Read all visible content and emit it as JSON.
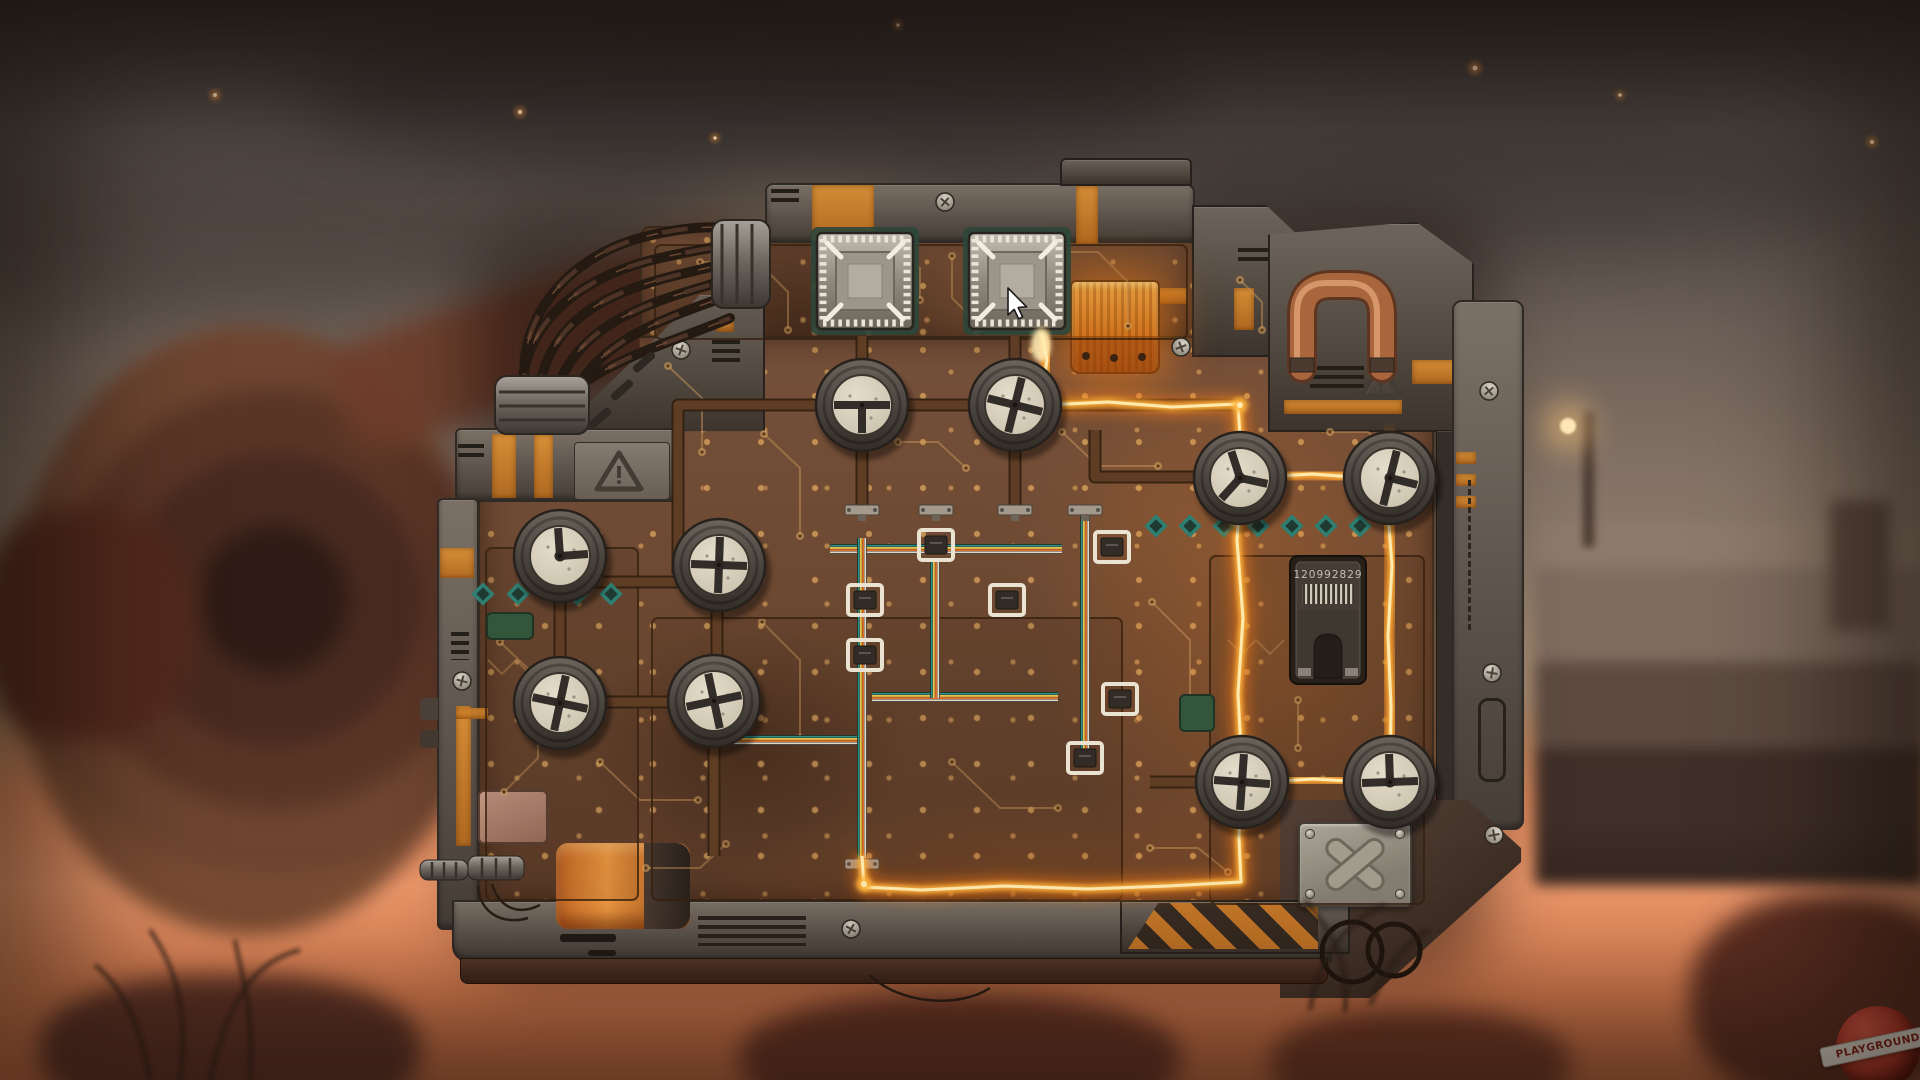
{
  "scene_type": "wasteland circuit-board valve puzzle",
  "watermark": {
    "text": "PLAYGROUND"
  },
  "device": {
    "chip_label": "120992829"
  },
  "cursor": {
    "x": 1008,
    "y": 288
  },
  "colors": {
    "trace": "#c89358",
    "pad": "#d9a763",
    "pipe_dark": "#32200f",
    "pipe": "#5f3d24",
    "glow_outer": "#ff7e14",
    "glow_mid": "#ffb43c",
    "glow_core": "#ffeab0",
    "teal": "#2e7f72",
    "dial_ring": "#514b45",
    "dial_face": "#d9d2c0",
    "spoke": "#322d28",
    "ribbon": [
      "#2e8f86",
      "#e8c14f",
      "#d96f28",
      "#ded8c8"
    ],
    "copper": "#a9663d",
    "accent_orange": "#d9822b"
  },
  "scene": {
    "dials": [
      {
        "x": 862,
        "y": 405,
        "s": "tee",
        "rot": 0,
        "hub": 0
      },
      {
        "x": 1015,
        "y": 405,
        "s": "cross",
        "rot": 14,
        "hub": 1
      },
      {
        "x": 1240,
        "y": 478,
        "s": "wye",
        "rot": -8,
        "hub": 1
      },
      {
        "x": 1390,
        "y": 478,
        "s": "tee",
        "rot": -76,
        "hub": 1
      },
      {
        "x": 560,
        "y": 556,
        "s": "ell",
        "rot": -4,
        "hub": 1
      },
      {
        "x": 719,
        "y": 565,
        "s": "cross",
        "rot": 2,
        "hub": 1
      },
      {
        "x": 560,
        "y": 703,
        "s": "cross",
        "rot": 12,
        "hub": 1
      },
      {
        "x": 714,
        "y": 701,
        "s": "cross",
        "rot": -12,
        "hub": 0
      },
      {
        "x": 1242,
        "y": 782,
        "s": "cross",
        "rot": 4,
        "hub": 1
      },
      {
        "x": 1390,
        "y": 782,
        "s": "tee",
        "rot": 178,
        "hub": 1
      }
    ],
    "spoke_styles": {
      "cross": [
        0,
        90,
        180,
        270
      ],
      "tee": [
        0,
        90,
        180
      ],
      "ell": [
        270,
        0
      ],
      "pointer": [
        90
      ],
      "wye": [
        20,
        140,
        260
      ]
    },
    "sockets": [
      {
        "x": 865,
        "y": 281
      },
      {
        "x": 1017,
        "y": 281
      }
    ],
    "pipes": [
      [
        [
          678,
          574
        ],
        [
          678,
          405
        ],
        [
          1240,
          405
        ]
      ],
      [
        [
          862,
          336
        ],
        [
          862,
          512
        ]
      ],
      [
        [
          1015,
          336
        ],
        [
          1015,
          512
        ]
      ],
      [
        [
          1095,
          430
        ],
        [
          1095,
          477
        ],
        [
          1240,
          477
        ]
      ],
      [
        [
          560,
          582
        ],
        [
          717,
          582
        ]
      ],
      [
        [
          717,
          564
        ],
        [
          717,
          702
        ]
      ],
      [
        [
          560,
          554
        ],
        [
          560,
          702
        ]
      ],
      [
        [
          558,
          702
        ],
        [
          716,
          702
        ]
      ],
      [
        [
          714,
          700
        ],
        [
          714,
          856
        ]
      ],
      [
        [
          1150,
          782
        ],
        [
          1244,
          782
        ]
      ]
    ],
    "glow": {
      "paths": [
        [
          [
            1042,
            334
          ],
          [
            1047,
            360
          ],
          [
            1043,
            386
          ],
          [
            1046,
            406
          ]
        ],
        [
          [
            1046,
            405
          ],
          [
            1108,
            402
          ],
          [
            1172,
            407
          ],
          [
            1238,
            404
          ],
          [
            1242,
            468
          ],
          [
            1237,
            540
          ],
          [
            1243,
            618
          ],
          [
            1238,
            694
          ],
          [
            1242,
            768
          ],
          [
            1239,
            838
          ],
          [
            1241,
            882
          ],
          [
            1168,
            886
          ],
          [
            1088,
            889
          ],
          [
            1004,
            886
          ],
          [
            922,
            890
          ],
          [
            864,
            887
          ],
          [
            862,
            856
          ]
        ],
        [
          [
            1261,
            477
          ],
          [
            1312,
            474
          ],
          [
            1366,
            478
          ]
        ],
        [
          [
            1391,
            434
          ],
          [
            1387,
            498
          ],
          [
            1392,
            566
          ],
          [
            1388,
            636
          ],
          [
            1391,
            706
          ],
          [
            1390,
            778
          ]
        ],
        [
          [
            1263,
            782
          ],
          [
            1313,
            779
          ],
          [
            1365,
            782
          ]
        ]
      ],
      "sparks": [
        [
          1046,
          405
        ],
        [
          1240,
          405
        ],
        [
          1241,
          477
        ],
        [
          1241,
          782
        ],
        [
          1390,
          478
        ],
        [
          1390,
          780
        ],
        [
          864,
          884
        ]
      ],
      "flame": {
        "x": 1041,
        "y": 345
      }
    },
    "ribbons": [
      {
        "o": "h",
        "pts": [
          [
            830,
            549
          ],
          [
            1062,
            549
          ]
        ]
      },
      {
        "o": "h",
        "pts": [
          [
            872,
            697
          ],
          [
            1058,
            697
          ]
        ]
      },
      {
        "o": "h",
        "pts": [
          [
            702,
            740
          ],
          [
            858,
            740
          ]
        ]
      },
      {
        "o": "v",
        "pts": [
          [
            935,
            562
          ],
          [
            935,
            698
          ]
        ]
      },
      {
        "o": "v",
        "pts": [
          [
            1085,
            505
          ],
          [
            1085,
            756
          ]
        ]
      },
      {
        "o": "v",
        "pts": [
          [
            862,
            538
          ],
          [
            862,
            858
          ]
        ]
      }
    ],
    "row_connectors": [
      [
        862,
        510
      ],
      [
        936,
        510
      ],
      [
        1015,
        510
      ],
      [
        1085,
        510
      ],
      [
        862,
        864
      ]
    ],
    "brackets": [
      [
        865,
        600
      ],
      [
        1007,
        600
      ],
      [
        865,
        655
      ],
      [
        1112,
        547
      ],
      [
        1120,
        699
      ],
      [
        1085,
        758
      ],
      [
        936,
        545
      ]
    ],
    "diamonds": {
      "left": {
        "y": 594,
        "xs": [
          483,
          518,
          577,
          611
        ]
      },
      "right": {
        "y": 526,
        "xs": [
          1156,
          1190,
          1224,
          1258,
          1292,
          1326,
          1360
        ]
      }
    },
    "green_chips": [
      [
        487,
        613,
        46,
        26
      ],
      [
        1180,
        695,
        34,
        36
      ]
    ],
    "regions": [
      [
        652,
        618,
        470,
        282
      ],
      [
        1210,
        556,
        214,
        348
      ],
      [
        655,
        245,
        532,
        94
      ],
      [
        486,
        548,
        152,
        352
      ]
    ],
    "traces": [
      [
        [
          700,
          262
        ],
        [
          758,
          262
        ],
        [
          788,
          292
        ],
        [
          788,
          330
        ]
      ],
      [
        [
          952,
          256
        ],
        [
          952,
          298
        ],
        [
          982,
          328
        ]
      ],
      [
        [
          1062,
          252
        ],
        [
          1098,
          252
        ],
        [
          1128,
          282
        ],
        [
          1128,
          326
        ]
      ],
      [
        [
          668,
          366
        ],
        [
          702,
          398
        ],
        [
          702,
          452
        ]
      ],
      [
        [
          764,
          434
        ],
        [
          800,
          468
        ],
        [
          800,
          536
        ]
      ],
      [
        [
          898,
          442
        ],
        [
          938,
          442
        ],
        [
          966,
          468
        ]
      ],
      [
        [
          1062,
          432
        ],
        [
          1098,
          466
        ],
        [
          1158,
          466
        ]
      ],
      [
        [
          500,
          642
        ],
        [
          538,
          678
        ],
        [
          538,
          758
        ],
        [
          504,
          792
        ]
      ],
      [
        [
          600,
          762
        ],
        [
          640,
          800
        ],
        [
          698,
          800
        ]
      ],
      [
        [
          762,
          622
        ],
        [
          800,
          660
        ],
        [
          800,
          738
        ]
      ],
      [
        [
          952,
          762
        ],
        [
          1000,
          808
        ],
        [
          1058,
          808
        ]
      ],
      [
        [
          1152,
          602
        ],
        [
          1190,
          640
        ],
        [
          1190,
          716
        ]
      ],
      [
        [
          1298,
          700
        ],
        [
          1298,
          748
        ]
      ],
      [
        [
          1330,
          432
        ],
        [
          1368,
          432
        ],
        [
          1398,
          460
        ]
      ],
      [
        [
          646,
          868
        ],
        [
          700,
          868
        ],
        [
          726,
          844
        ]
      ],
      [
        [
          1150,
          848
        ],
        [
          1198,
          848
        ],
        [
          1228,
          872
        ]
      ],
      [
        [
          890,
          240
        ],
        [
          920,
          268
        ],
        [
          920,
          300
        ]
      ],
      [
        [
          1240,
          280
        ],
        [
          1262,
          302
        ],
        [
          1262,
          330
        ]
      ]
    ],
    "chevrons": [
      [
        [
          488,
          660
        ],
        [
          502,
          674
        ],
        [
          516,
          660
        ],
        [
          530,
          674
        ],
        [
          544,
          660
        ]
      ],
      [
        [
          1228,
          640
        ],
        [
          1242,
          654
        ],
        [
          1256,
          640
        ],
        [
          1270,
          654
        ],
        [
          1284,
          640
        ]
      ]
    ],
    "screws": [
      [
        681,
        350,
        20
      ],
      [
        945,
        202,
        40
      ],
      [
        1181,
        347,
        70
      ],
      [
        462,
        681,
        15
      ],
      [
        1489,
        391,
        50
      ],
      [
        1492,
        673,
        10
      ],
      [
        1494,
        835,
        80
      ],
      [
        851,
        929,
        30
      ]
    ],
    "xplate_screws": [
      [
        1310,
        834
      ],
      [
        1400,
        834
      ],
      [
        1310,
        894
      ],
      [
        1400,
        894
      ]
    ],
    "cap_dots": [
      [
        1086,
        356
      ],
      [
        1114,
        358
      ],
      [
        1142,
        357
      ]
    ],
    "triangles": [
      {
        "name": "warning-triangle-icon",
        "pts": [
          [
            619,
            453
          ],
          [
            597,
            489
          ],
          [
            641,
            489
          ]
        ],
        "bang": [
          619,
          466,
          482
        ]
      },
      {
        "name": "warning-triangle-icon",
        "pts": [
          [
            1381,
            364
          ],
          [
            1362,
            396
          ],
          [
            1400,
            396
          ]
        ],
        "bang": [
          1381,
          374,
          391
        ]
      }
    ],
    "copper_pipe": {
      "d": "M1302,368 L1302,315 Q1302,285 1332,285 L1352,285 Q1382,285 1382,315 L1382,368",
      "flanges": [
        [
          1290,
          358,
          24,
          14
        ],
        [
          1370,
          358,
          24,
          14
        ]
      ]
    },
    "cables": [
      "M522,398 C520,320 585,275 660,258 C700,249 722,246 736,244",
      "M538,400 C545,318 610,290 690,272 C715,266 730,262 742,258",
      "M554,402 C568,330 640,305 706,286 C722,281 734,277 744,272",
      "M570,404 C590,345 660,320 716,300 C730,295 740,291 748,287",
      "M528,399 C510,330 560,260 640,238 C680,227 710,226 734,228",
      "M560,403 C600,360 680,340 730,318"
    ],
    "cyl_upper": {
      "x": 712,
      "y": 220,
      "w": 58,
      "h": 88,
      "ribs": [
        722,
        737,
        752
      ]
    },
    "cyl_lower": {
      "x": 495,
      "y": 376,
      "w": 94,
      "h": 58,
      "ribs": [
        392,
        406,
        420
      ]
    },
    "pins": [
      [
        420,
        860,
        48,
        20
      ],
      [
        468,
        856,
        56,
        24
      ]
    ],
    "thin_wires": [
      "M492,884 C500,910 520,915 540,905",
      "M478,886 C480,915 505,925 528,918",
      "M870,975 C900,1005 960,1008 990,988"
    ],
    "strut_slots": [
      [
        600,
        418
      ],
      [
        622,
        390
      ],
      [
        644,
        362
      ]
    ],
    "wire_loops": [
      [
        1352,
        952,
        30
      ],
      [
        1394,
        950,
        26
      ]
    ],
    "plants": {
      "left": [
        "M180,1080 C190,1000 170,960 150,930",
        "M210,1080 C230,990 260,960 300,950",
        "M250,1080 C255,1010 240,970 235,940",
        "M150,1080 C140,1020 120,985 95,965"
      ],
      "right": [
        "M1310,1010 C1320,950 1350,920 1385,905",
        "M1345,1012 C1350,960 1330,930 1305,900",
        "M1370,1005 C1390,960 1410,940 1428,930"
      ]
    },
    "embers": [
      [
        215,
        95,
        2.5
      ],
      [
        520,
        112,
        2.5
      ],
      [
        715,
        138,
        2
      ],
      [
        898,
        25,
        2
      ],
      [
        1475,
        68,
        3
      ],
      [
        1872,
        142,
        2.5
      ],
      [
        1620,
        95,
        2
      ]
    ]
  }
}
